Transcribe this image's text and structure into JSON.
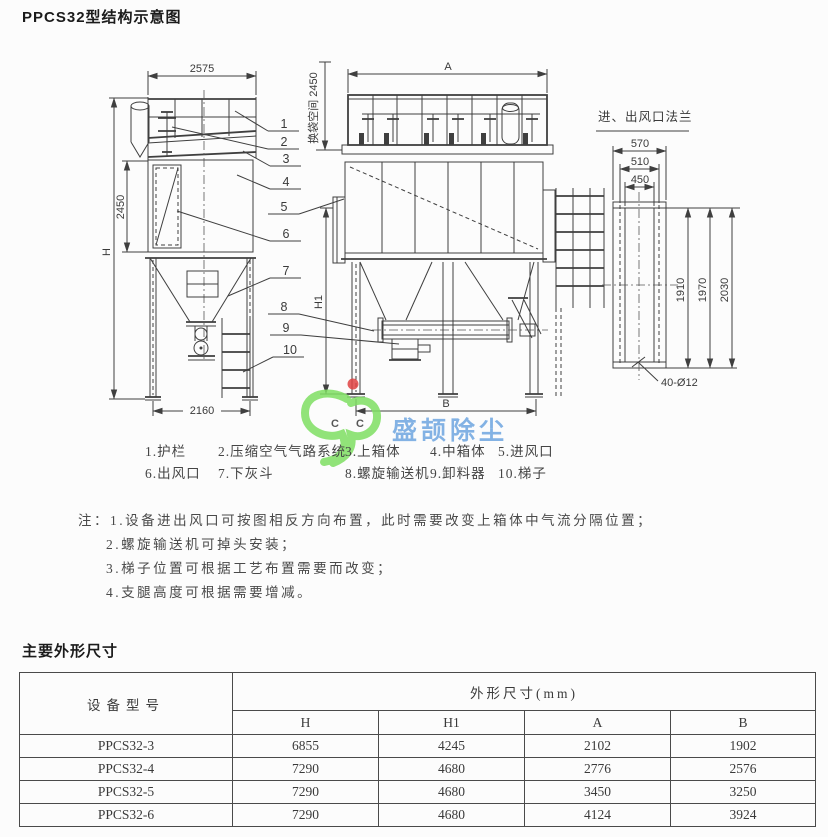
{
  "page": {
    "title": "PPCS32型结构示意图",
    "section_title": "主要外形尺寸"
  },
  "diagram": {
    "side_view_dims": {
      "top_width": "2575",
      "total_height": "H",
      "bag_zone_height": "2450",
      "bottom_width": "2160",
      "headroom": "换袋空间 2450"
    },
    "front_view_dims": {
      "top_width": "A",
      "leg_height": "H1",
      "bottom_width": "B"
    },
    "flange_view": {
      "title": "进、出风口法兰",
      "w1": "570",
      "w2": "510",
      "w3": "450",
      "h1": "1910",
      "h2": "1970",
      "h3": "2030",
      "holes": "40-Ø12"
    },
    "callouts": [
      "1",
      "2",
      "3",
      "4",
      "5",
      "6",
      "7",
      "8",
      "9",
      "10"
    ]
  },
  "parts_row1": [
    "1.护栏",
    "2.压缩空气气路系统",
    "3.上箱体",
    "4.中箱体",
    "5.进风口"
  ],
  "parts_row2": [
    "6.出风口",
    "7.下灰斗",
    "8.螺旋输送机",
    "9.卸料器",
    "10.梯子"
  ],
  "notes": {
    "prefix": "注：",
    "lines": [
      "1.设备进出风口可按图相反方向布置，此时需要改变上箱体中气流分隔位置；",
      "2.螺旋输送机可掉头安装；",
      "3.梯子位置可根据工艺布置需要而改变；",
      "4.支腿高度可根据需要增减。"
    ]
  },
  "watermark": {
    "text": "盛颉除尘",
    "letters": [
      "C",
      "C"
    ],
    "colors": {
      "green": "#7fdf63",
      "red": "#e04343",
      "yellow": "#f2dc35",
      "blue": "#6ea6e0"
    }
  },
  "table": {
    "col1_header": "设备型号",
    "group_header": "外形尺寸(mm)",
    "sub_headers": [
      "H",
      "H1",
      "A",
      "B"
    ],
    "rows": [
      {
        "model": "PPCS32-3",
        "values": [
          "6855",
          "4245",
          "2102",
          "1902"
        ]
      },
      {
        "model": "PPCS32-4",
        "values": [
          "7290",
          "4680",
          "2776",
          "2576"
        ]
      },
      {
        "model": "PPCS32-5",
        "values": [
          "7290",
          "4680",
          "3450",
          "3250"
        ]
      },
      {
        "model": "PPCS32-6",
        "values": [
          "7290",
          "4680",
          "4124",
          "3924"
        ]
      }
    ]
  }
}
